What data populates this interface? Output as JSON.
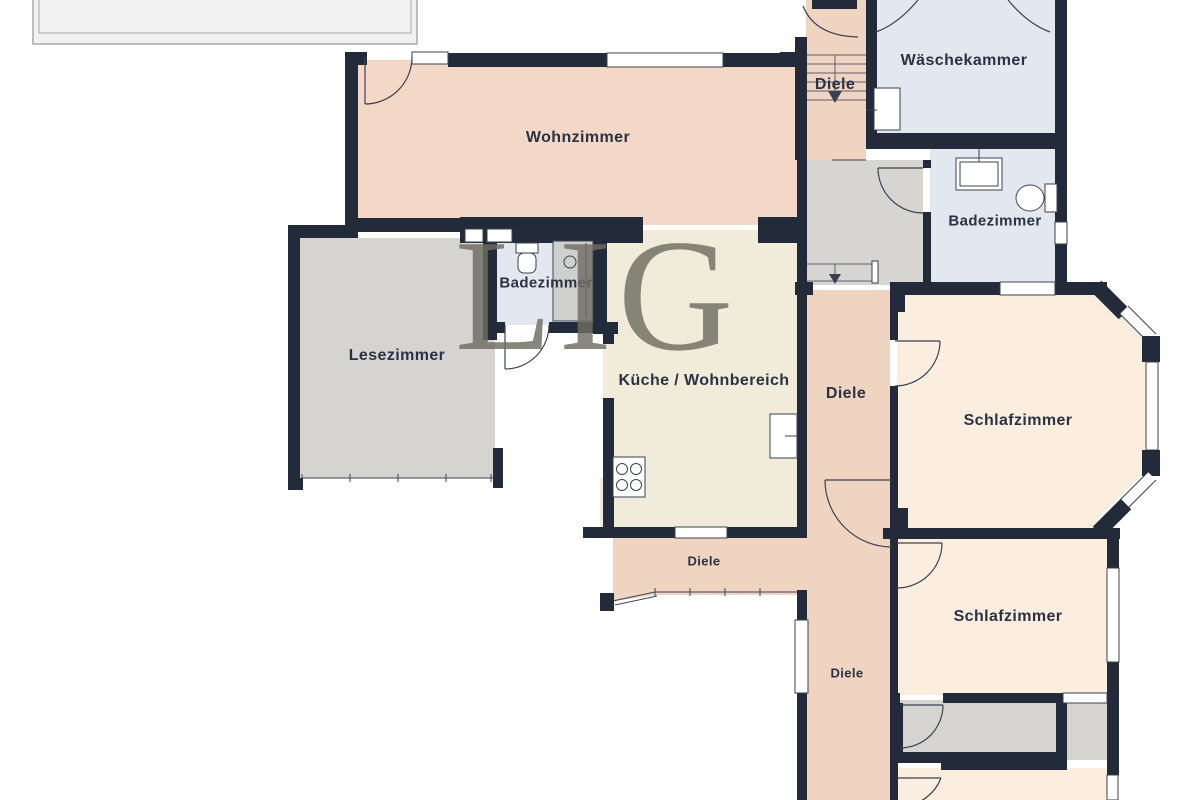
{
  "watermark": "LIG",
  "rooms": {
    "wohnzimmer": {
      "label": "Wohnzimmer"
    },
    "diele_top": {
      "label": "Diele"
    },
    "waeschekammer": {
      "label": "Wäschekammer"
    },
    "badezimmer_top": {
      "label": "Badezimmer"
    },
    "badezimmer_mid": {
      "label": "Badezimmer"
    },
    "lesezimmer": {
      "label": "Lesezimmer"
    },
    "kueche": {
      "label": "Küche / Wohnbereich"
    },
    "diele_mid": {
      "label": "Diele"
    },
    "schlafzimmer_1": {
      "label": "Schlafzimmer"
    },
    "diele_bottom": {
      "label": "Diele"
    },
    "schlafzimmer_2": {
      "label": "Schlafzimmer"
    },
    "diele_bottom_2": {
      "label": "Diele"
    }
  },
  "colors": {
    "wall": "#232b3a",
    "floor_living": "#f3d8c7",
    "floor_hallway": "#f0d4c2",
    "floor_bedroom": "#fbeede",
    "floor_kitchen": "#f1ebd9",
    "floor_bathroom": "#e3e8f0",
    "floor_gray": "#d5d4d1",
    "terrace": "#f1f1f2",
    "watermark_color": "#6f6d62",
    "label_color": "#2a3244"
  }
}
